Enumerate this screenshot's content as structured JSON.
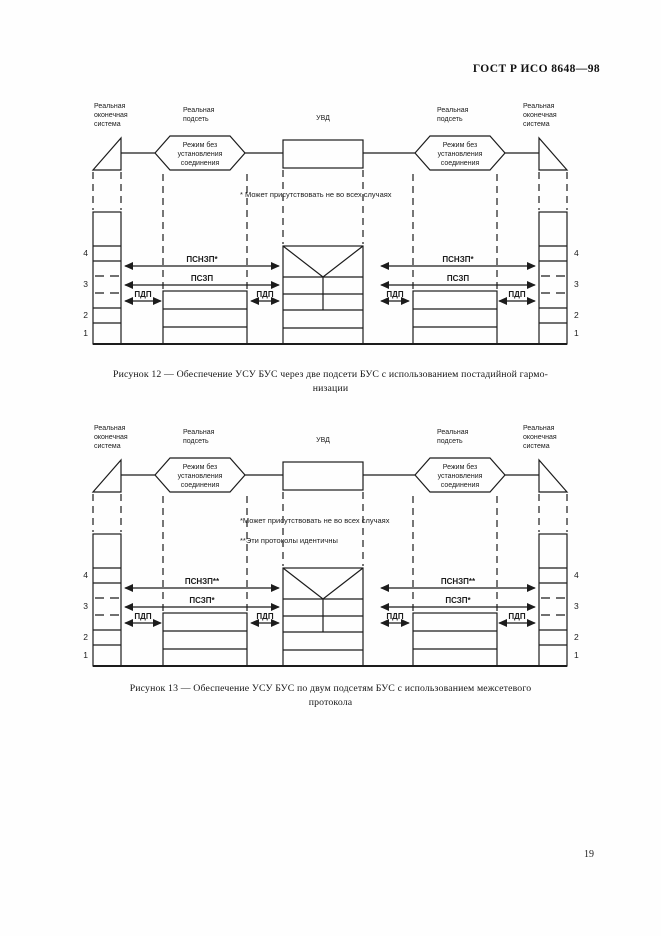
{
  "page": {
    "header": "ГОСТ Р ИСО 8648—98",
    "page_number": "19"
  },
  "layers": [
    "4",
    "3",
    "2",
    "1"
  ],
  "fig12": {
    "caption_lines": [
      "Рисунок 12 — Обеспечение УСУ БУС через две подсети БУС  с  использованием постадийной  гармо-",
      "низации"
    ],
    "node_labels": {
      "left_end_system": [
        "Реальная",
        "оконечная",
        "система"
      ],
      "left_subnet": [
        "Реальная",
        "подсеть"
      ],
      "uvd": "УВД",
      "right_subnet": [
        "Реальная",
        "подсеть"
      ],
      "right_end_system": [
        "Реальная",
        "оконечная",
        "система"
      ]
    },
    "hexagon": [
      "Режим без",
      "установления",
      "соединения"
    ],
    "footnotes": [
      "* Может присутствовать не во всех случаях"
    ],
    "arrows": {
      "psnzp": "ПСНЗП*",
      "pszp": "ПСЗП",
      "pdp": "ПДП"
    }
  },
  "fig13": {
    "caption_lines": [
      "Рисунок 13 — Обеспечение  УСУ  БУС  по  двум  подсетям  БУС  с  использованием  межсетевого",
      "протокола"
    ],
    "node_labels": {
      "left_end_system": [
        "Реальная",
        "оконечная",
        "система"
      ],
      "left_subnet": [
        "Реальная",
        "подсеть"
      ],
      "uvd": "УВД",
      "right_subnet": [
        "Реальная",
        "подсеть"
      ],
      "right_end_system": [
        "Реальная",
        "оконечная",
        "система"
      ]
    },
    "hexagon": [
      "Режим без",
      "установления",
      "соединения"
    ],
    "footnotes": [
      "*Может присутствовать не во всех случаях",
      "**Эти протоколы идентичны"
    ],
    "arrows": {
      "psnzp": "ПСНЗП**",
      "pszp": "ПСЗП*",
      "pdp": "ПДП"
    }
  }
}
